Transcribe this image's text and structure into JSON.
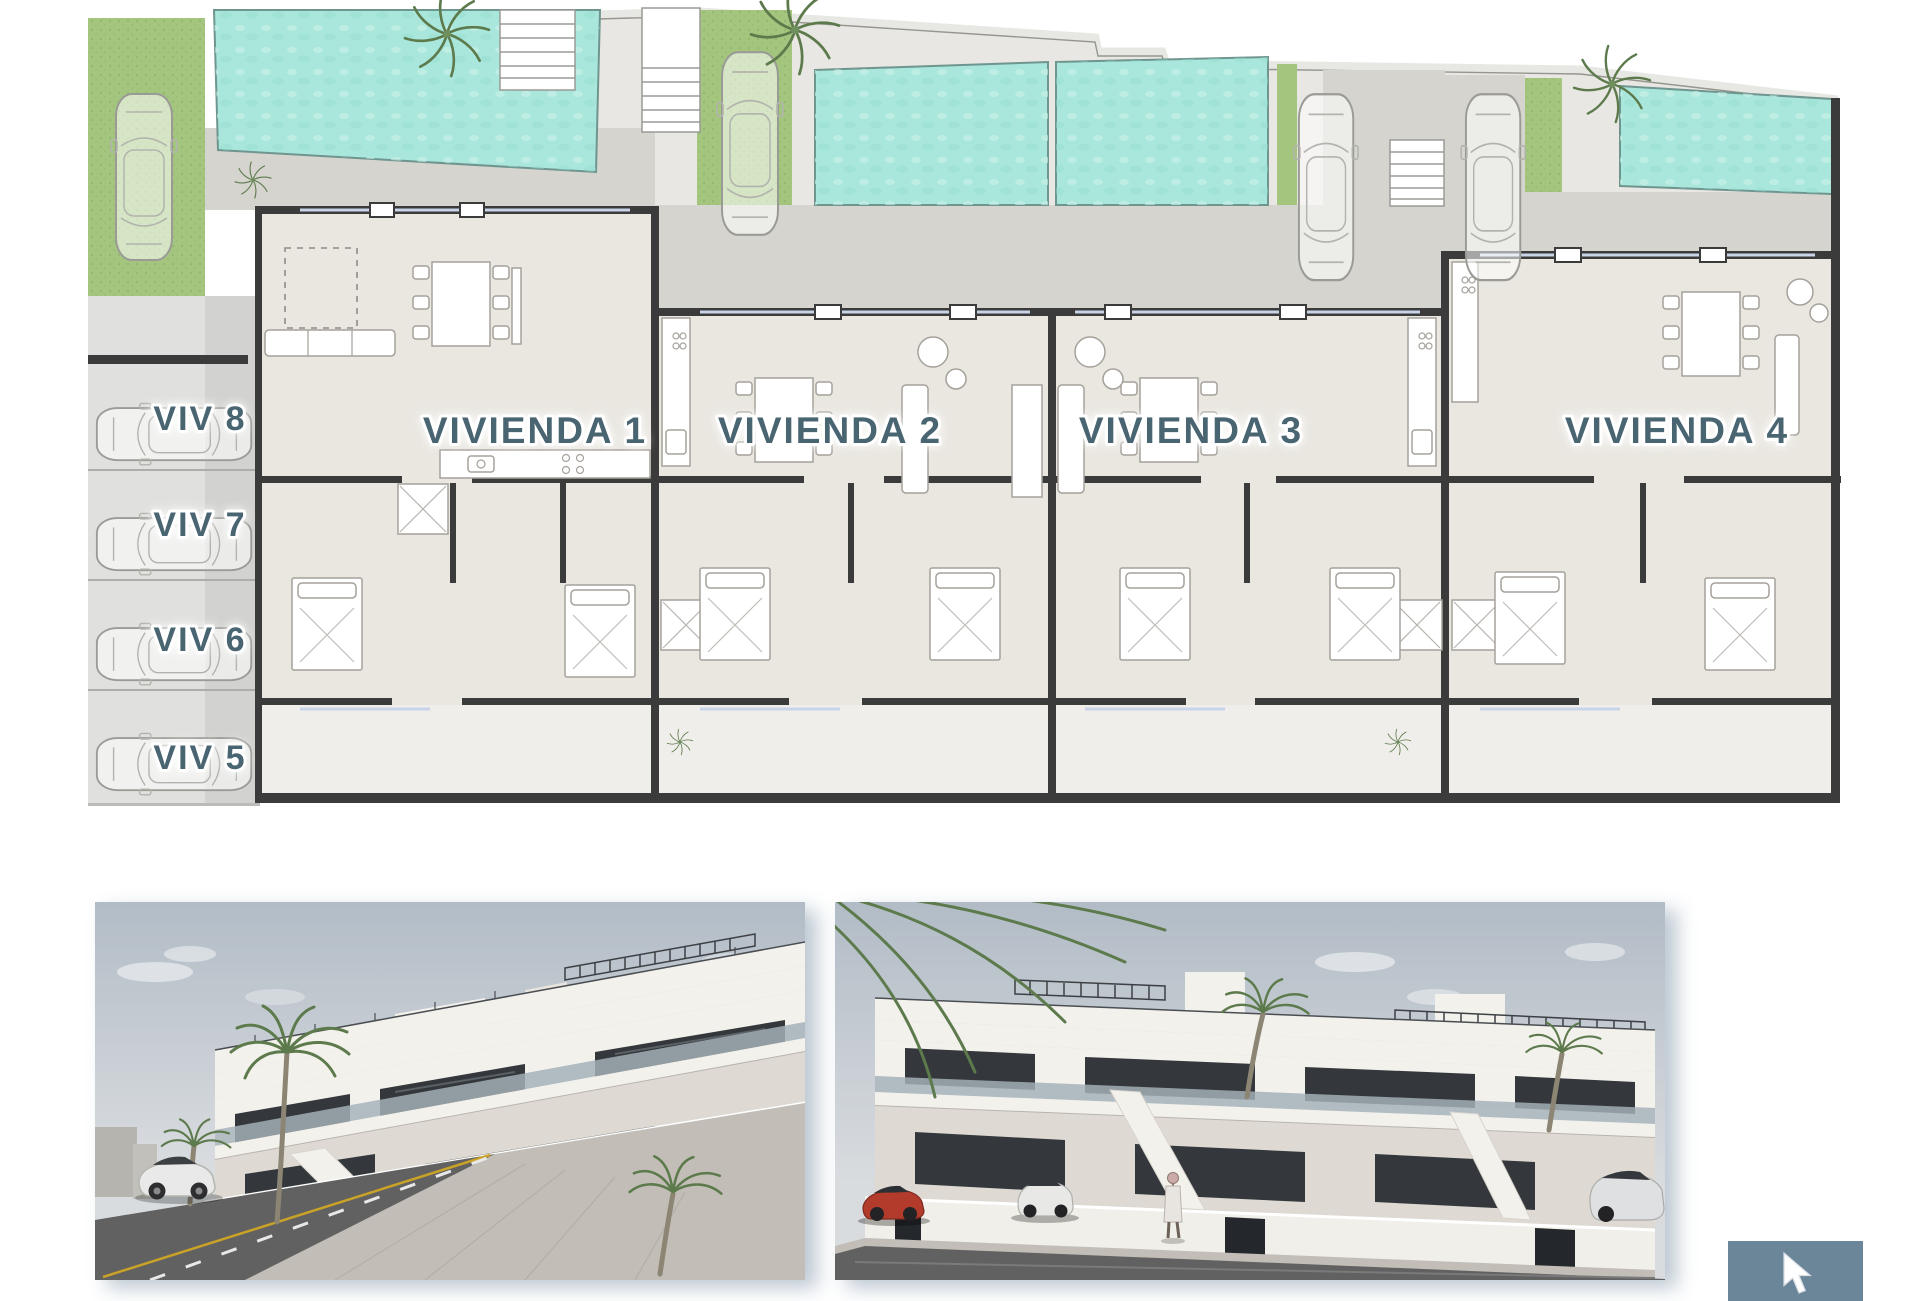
{
  "floor_plan": {
    "units": [
      {
        "label": "VIVIENDA 1"
      },
      {
        "label": "VIVIENDA 2"
      },
      {
        "label": "VIVIENDA 3"
      },
      {
        "label": "VIVIENDA 4"
      }
    ],
    "parking_spots": [
      {
        "label": "VIV 8"
      },
      {
        "label": "VIV 7"
      },
      {
        "label": "VIV 6"
      },
      {
        "label": "VIV 5"
      }
    ]
  },
  "colors": {
    "pool": "#a9e6db",
    "pool_edge": "#6f958f",
    "grass": "#a3c57e",
    "wall": "#3b3b3b",
    "floor": "#eae7e1",
    "terrace": "#d6d4cf",
    "patio": "#f0eeea",
    "outdoor": "#e9e7e3",
    "parking": "#e0e0de",
    "parking_shade": "#d2d2d0",
    "label": "#4a6572",
    "window": "#c9d4e8",
    "furniture": "#a5a19a",
    "palm_dark": "#5d7a4c",
    "sky_top": "#b2bcc6",
    "sky_bottom": "#d9dcdf",
    "building": "#f3f1ec",
    "building_shade": "#dedad3",
    "glass_dark": "#34383c",
    "glass_light": "#aab6bd",
    "fence": "#f1efe9",
    "gate": "#24272b",
    "road": "#616161",
    "sidewalk": "#c2beb7",
    "yellow_line": "#c9a227",
    "red_car": "#b23b2c",
    "cursor": "#6b8599"
  }
}
